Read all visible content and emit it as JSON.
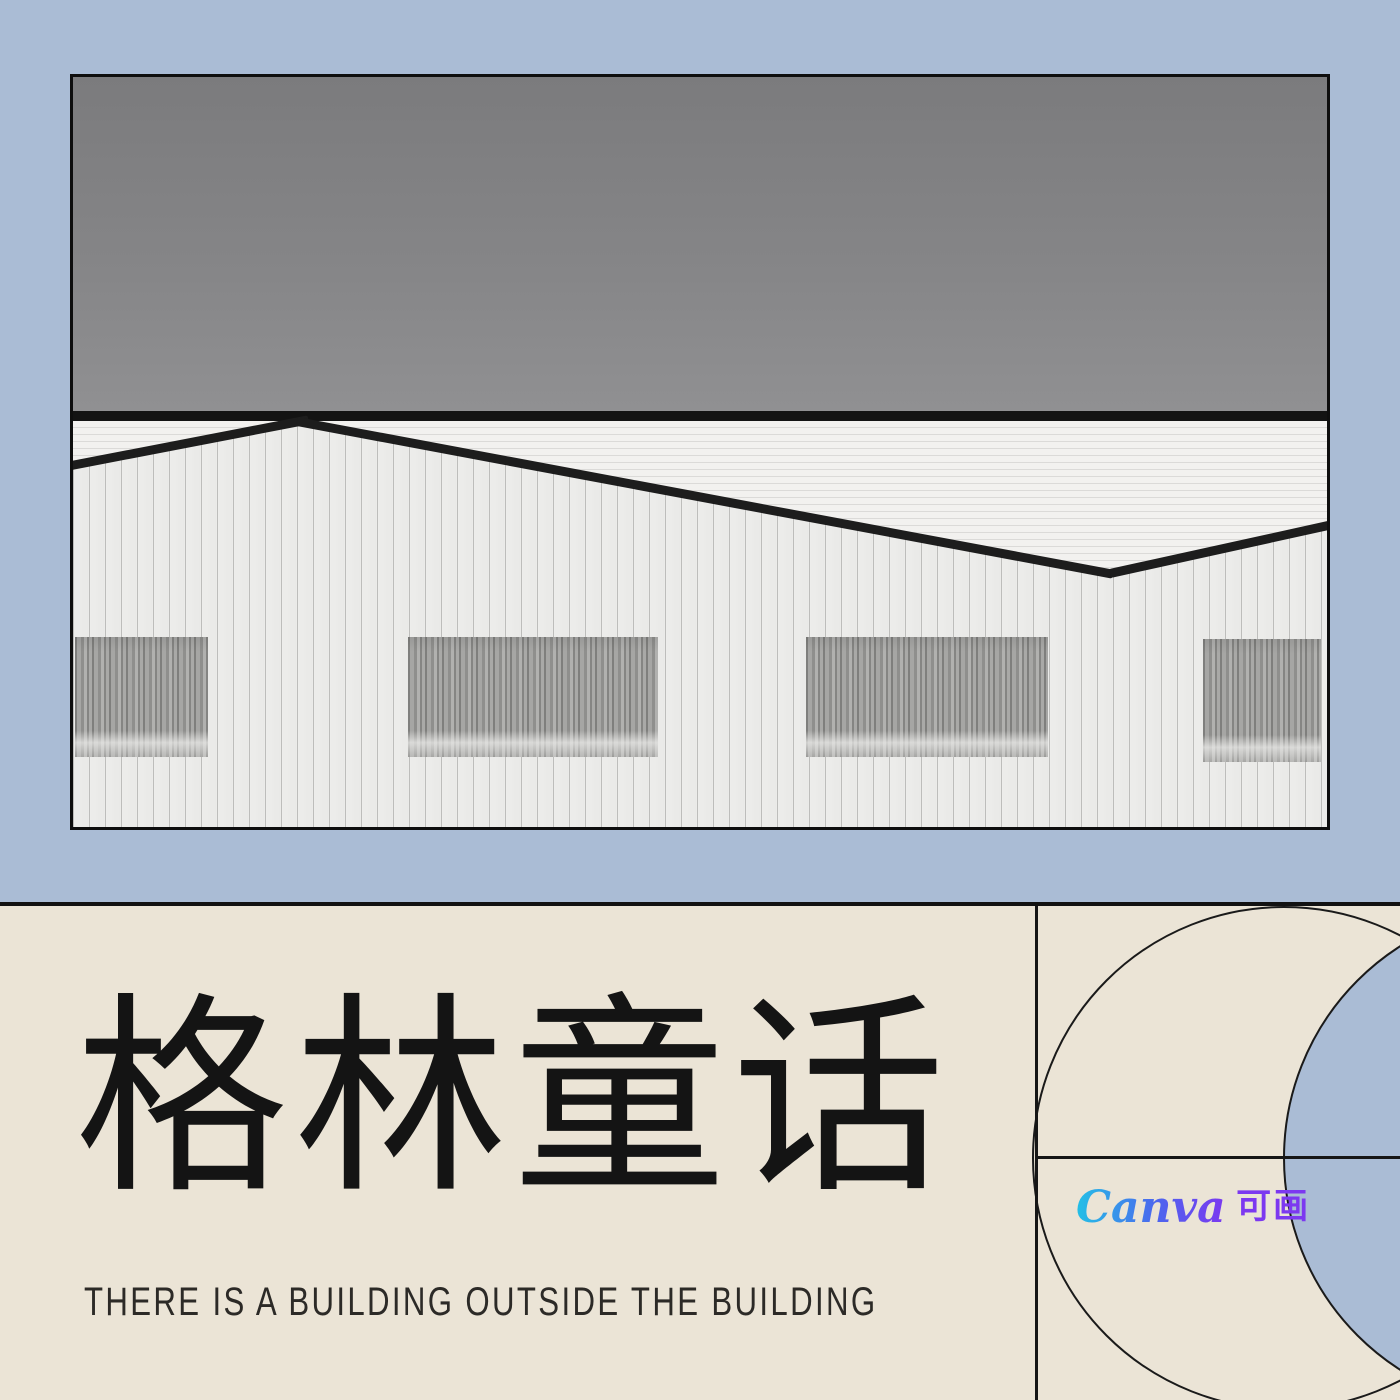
{
  "poster": {
    "title": "格林童话",
    "subtitle": "THERE IS A BUILDING OUTSIDE THE BUILDING",
    "logo": {
      "brand": "Canva",
      "suffix": "可画"
    }
  },
  "photo": {
    "subject": "black and white industrial building with corrugated walls under gray sky"
  },
  "colors": {
    "top_background": "#aabcd5",
    "bottom_background": "#ebe4d6",
    "line_black": "#141414",
    "crescent_fill": "#aabcd5",
    "title_color": "#141414",
    "logo_gradient": [
      "#23c0e6",
      "#4e64ee",
      "#7c38f0"
    ],
    "logo_purple": "#7c38f0"
  }
}
